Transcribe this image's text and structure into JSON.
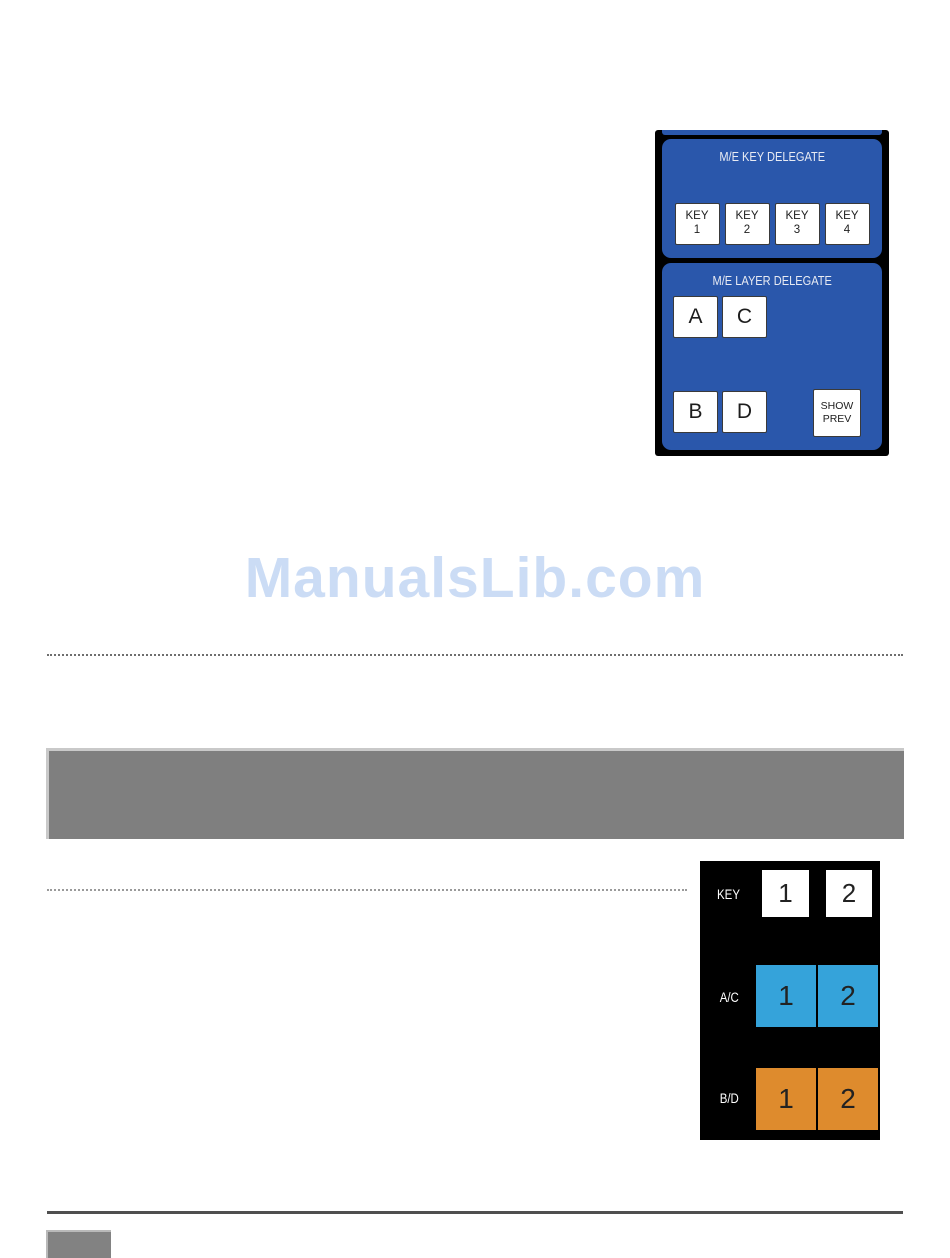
{
  "watermark": {
    "text": "ManualsLib.com",
    "color": "#cbdcf5"
  },
  "colors": {
    "delegate_panel_blue": "#2a57ab",
    "figure_background": "#000000",
    "bus_blue": "#35a3da",
    "bus_orange": "#de8b2d",
    "banner_gray": "#7f7f7f",
    "rule_gray": "#4f4f4f"
  },
  "delegate_figure": {
    "key_section": {
      "title": "M/E KEY DELEGATE",
      "buttons": [
        "KEY\n1",
        "KEY\n2",
        "KEY\n3",
        "KEY\n4"
      ]
    },
    "layer_section": {
      "title": "M/E LAYER DELEGATE",
      "row1": [
        "A",
        "C"
      ],
      "row2": [
        "B",
        "D"
      ],
      "show_prev": "SHOW\nPREV"
    }
  },
  "bus_figure": {
    "rows": [
      {
        "label": "KEY",
        "buttons": [
          "1",
          "2"
        ]
      },
      {
        "label": "A/C",
        "buttons": [
          "1",
          "2"
        ]
      },
      {
        "label": "B/D",
        "buttons": [
          "1",
          "2"
        ]
      }
    ]
  }
}
